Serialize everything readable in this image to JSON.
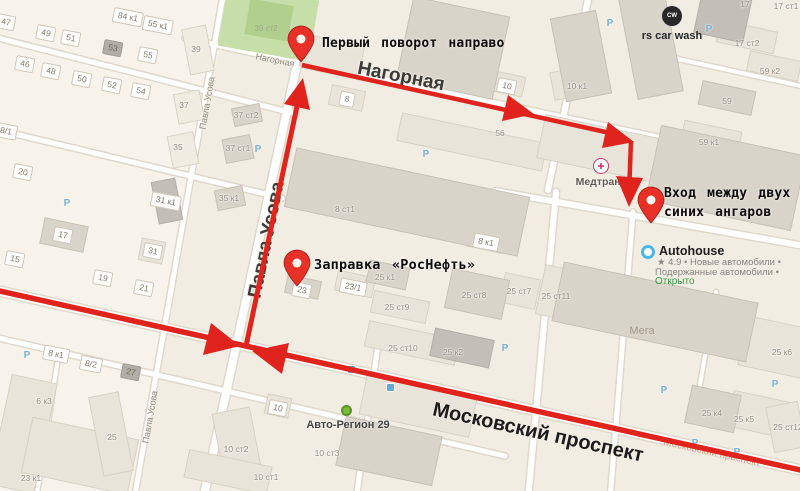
{
  "map": {
    "annotations": {
      "first_turn": "Первый поворот направо",
      "gas_station": "Заправка «РосНефть»",
      "entrance_line1": "Вход между двух",
      "entrance_line2": "синих ангаров"
    },
    "streets": {
      "nagornaya": "Нагорная",
      "nagornaya_small": "Нагорная",
      "pavla_usova": "Павла Усова",
      "pavla_usova_small_top": "Павла Усова",
      "pavla_usova_small_bottom": "Павла Усова",
      "moskovsky": "Московский проспект",
      "moskovsky_small": "Московский проспект"
    },
    "pois": {
      "car_wash": {
        "icon_text": "CW",
        "name": "rs car wash"
      },
      "medtrans": {
        "icon_text": "✚",
        "name": "Медтранс"
      },
      "autohouse": {
        "name": "Autohouse",
        "rating_line": "★ 4.9 • Новые автомобили •",
        "secondary_line": "Подержанные автомобили •",
        "status": "Открыто"
      },
      "autoregion": {
        "name": "Авто-Регион 29"
      },
      "mega": {
        "name": "Мега"
      }
    },
    "badges": [
      {
        "t": "47",
        "x": 6,
        "y": 22,
        "k": "house"
      },
      {
        "t": "49",
        "x": 46,
        "y": 33,
        "k": "house"
      },
      {
        "t": "51",
        "x": 71,
        "y": 38,
        "k": "house"
      },
      {
        "t": "84 к1",
        "x": 128,
        "y": 17,
        "k": "house"
      },
      {
        "t": "55 к1",
        "x": 158,
        "y": 25,
        "k": "house"
      },
      {
        "t": "53",
        "x": 113,
        "y": 48,
        "k": "dark"
      },
      {
        "t": "55",
        "x": 148,
        "y": 55,
        "k": "house"
      },
      {
        "t": "46",
        "x": 25,
        "y": 64,
        "k": "house"
      },
      {
        "t": "48",
        "x": 51,
        "y": 71,
        "k": "house"
      },
      {
        "t": "50",
        "x": 82,
        "y": 79,
        "k": "house"
      },
      {
        "t": "52",
        "x": 112,
        "y": 85,
        "k": "house"
      },
      {
        "t": "54",
        "x": 141,
        "y": 91,
        "k": "house"
      },
      {
        "t": "8/1",
        "x": 6,
        "y": 131,
        "k": "house"
      },
      {
        "t": "20",
        "x": 23,
        "y": 172,
        "k": "house"
      },
      {
        "t": "15",
        "x": 15,
        "y": 259,
        "k": "house"
      },
      {
        "t": "17",
        "x": 63,
        "y": 235,
        "k": "house"
      },
      {
        "t": "19",
        "x": 103,
        "y": 278,
        "k": "house"
      },
      {
        "t": "21",
        "x": 144,
        "y": 288,
        "k": "house"
      },
      {
        "t": "31",
        "x": 153,
        "y": 251,
        "k": "house"
      },
      {
        "t": "31 к1",
        "x": 166,
        "y": 201,
        "k": "house"
      },
      {
        "t": "8 к1",
        "x": 56,
        "y": 354,
        "k": "house"
      },
      {
        "t": "8/2",
        "x": 91,
        "y": 364,
        "k": "house"
      },
      {
        "t": "27",
        "x": 131,
        "y": 372,
        "k": "dark"
      },
      {
        "t": "8",
        "x": 347,
        "y": 99,
        "k": "house"
      },
      {
        "t": "10",
        "x": 507,
        "y": 86,
        "k": "house"
      },
      {
        "t": "23",
        "x": 302,
        "y": 290,
        "k": "house"
      },
      {
        "t": "23/1",
        "x": 353,
        "y": 287,
        "k": "house"
      },
      {
        "t": "8 к1",
        "x": 486,
        "y": 242,
        "k": "house"
      },
      {
        "t": "10",
        "x": 278,
        "y": 408,
        "k": "house"
      },
      {
        "t": "6 к3",
        "x": 44,
        "y": 401,
        "k": "plain"
      },
      {
        "t": "25",
        "x": 112,
        "y": 437,
        "k": "plain"
      },
      {
        "t": "23 к1",
        "x": 31,
        "y": 478,
        "k": "plain"
      },
      {
        "t": "35 к1",
        "x": 229,
        "y": 198,
        "k": "plain"
      },
      {
        "t": "37 ст2",
        "x": 246,
        "y": 115,
        "k": "plain"
      },
      {
        "t": "37 ст1",
        "x": 238,
        "y": 148,
        "k": "plain"
      },
      {
        "t": "39",
        "x": 196,
        "y": 49,
        "k": "plain"
      },
      {
        "t": "37",
        "x": 184,
        "y": 105,
        "k": "plain"
      },
      {
        "t": "35",
        "x": 178,
        "y": 147,
        "k": "plain"
      },
      {
        "t": "56",
        "x": 500,
        "y": 133,
        "k": "plain"
      },
      {
        "t": "8 ст1",
        "x": 345,
        "y": 209,
        "k": "plain"
      },
      {
        "t": "25 к1",
        "x": 385,
        "y": 277,
        "k": "plain"
      },
      {
        "t": "25 ст8",
        "x": 474,
        "y": 295,
        "k": "plain"
      },
      {
        "t": "25 ст7",
        "x": 519,
        "y": 291,
        "k": "plain"
      },
      {
        "t": "25 ст11",
        "x": 556,
        "y": 296,
        "k": "plain"
      },
      {
        "t": "25 ст9",
        "x": 397,
        "y": 307,
        "k": "plain"
      },
      {
        "t": "25 ст10",
        "x": 403,
        "y": 348,
        "k": "plain"
      },
      {
        "t": "25 к2",
        "x": 453,
        "y": 352,
        "k": "plain"
      },
      {
        "t": "10 ст2",
        "x": 236,
        "y": 449,
        "k": "plain"
      },
      {
        "t": "10 ст1",
        "x": 266,
        "y": 477,
        "k": "plain"
      },
      {
        "t": "10 ст3",
        "x": 327,
        "y": 453,
        "k": "plain"
      },
      {
        "t": "25 к4",
        "x": 712,
        "y": 413,
        "k": "plain"
      },
      {
        "t": "25 к5",
        "x": 744,
        "y": 419,
        "k": "plain"
      },
      {
        "t": "25 ст12",
        "x": 788,
        "y": 427,
        "k": "plain"
      },
      {
        "t": "25 к6",
        "x": 782,
        "y": 352,
        "k": "plain"
      },
      {
        "t": "17",
        "x": 745,
        "y": 4,
        "k": "plain"
      },
      {
        "t": "17 ст1",
        "x": 786,
        "y": 6,
        "k": "plain"
      },
      {
        "t": "17 ст2",
        "x": 747,
        "y": 43,
        "k": "plain"
      },
      {
        "t": "59 к2",
        "x": 770,
        "y": 71,
        "k": "plain"
      },
      {
        "t": "59",
        "x": 727,
        "y": 101,
        "k": "plain"
      },
      {
        "t": "59 к1",
        "x": 709,
        "y": 142,
        "k": "plain"
      },
      {
        "t": "10 к1",
        "x": 577,
        "y": 86,
        "k": "plain"
      },
      {
        "t": "39 ст2",
        "x": 266,
        "y": 29,
        "k": "faint"
      }
    ],
    "parking": [
      {
        "t": "Р",
        "x": 610,
        "y": 24
      },
      {
        "t": "Р",
        "x": 709,
        "y": 30
      },
      {
        "t": "Р",
        "x": 27,
        "y": 356
      },
      {
        "t": "Р",
        "x": 505,
        "y": 349
      },
      {
        "t": "Р",
        "x": 664,
        "y": 391
      },
      {
        "t": "Р",
        "x": 775,
        "y": 385
      },
      {
        "t": "Р",
        "x": 695,
        "y": 444
      },
      {
        "t": "Р",
        "x": 737,
        "y": 453
      },
      {
        "t": "Р",
        "x": 258,
        "y": 150
      },
      {
        "t": "Р",
        "x": 426,
        "y": 155
      },
      {
        "t": "Р",
        "x": 67,
        "y": 204
      }
    ]
  }
}
